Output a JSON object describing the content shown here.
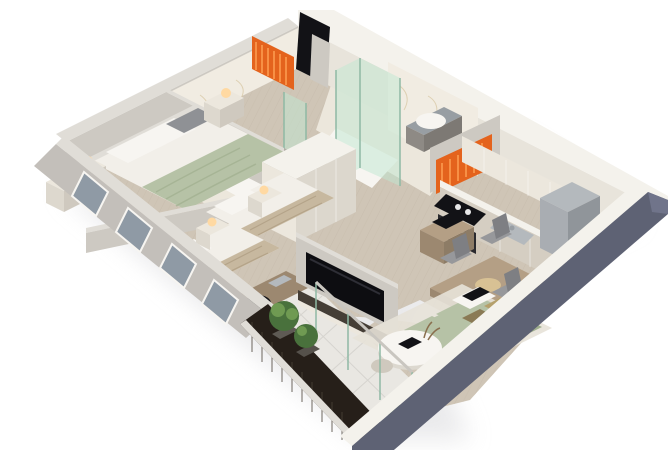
{
  "scene": {
    "title": "3D isometric apartment floor plan render",
    "description": "Cut-away 3D render of a two-bedroom apartment viewed from above: two bathrooms with glass showers and orange towel radiators, master bedroom with double bed, second bedroom with two single beds and desk, central wardrobe, wall TV, kitchen with cooktop and fridge, dining table with chairs, sage-green sofa with round coffee table, and a balcony with dark wood slats and plants.",
    "style": "isometric cutaway, white background, soft shadow"
  },
  "rooms": [
    {
      "name": "bathroom-1",
      "items": [
        "orange-towel-radiator",
        "toilet",
        "glass-shower",
        "marble-walls"
      ]
    },
    {
      "name": "entry-hall",
      "items": [
        "dark-entry-door",
        "herringbone-floor"
      ]
    },
    {
      "name": "bathroom-2",
      "items": [
        "glass-shower",
        "wall-hung-sink",
        "marble-walls",
        "orange-towel-radiator"
      ]
    },
    {
      "name": "master-bedroom",
      "items": [
        "double-bed-sage-throw",
        "two-nightstands-with-lamps",
        "dresser-with-lamp",
        "wardrobe",
        "windows"
      ]
    },
    {
      "name": "second-bedroom",
      "items": [
        "single-bed-a",
        "single-bed-b",
        "nightstands-with-lamps",
        "desk-with-chair",
        "windows"
      ]
    },
    {
      "name": "kitchen",
      "items": [
        "upper-cabinets",
        "cooktop",
        "oven",
        "sink",
        "fridge",
        "microwave-cabinet"
      ]
    },
    {
      "name": "dining-area",
      "items": [
        "wood-table",
        "four-gray-chairs",
        "round-tray"
      ]
    },
    {
      "name": "living-room",
      "items": [
        "sage-sofa",
        "round-coffee-table",
        "rug",
        "tv-partition",
        "media-console",
        "decor"
      ]
    },
    {
      "name": "balcony",
      "items": [
        "dark-slat-wall",
        "white-tile-floor",
        "potted-plants",
        "glass-sliding-door"
      ]
    }
  ],
  "palette": {
    "bg": "#ffffff",
    "shadow": "#d9d9dc",
    "wallDark": "#5e6274",
    "wallDarkLight": "#70748a",
    "wallCreamTop": "#f4f2ec",
    "wallCreamFace": "#e8e4db",
    "wallGrayTop": "#e0ddd7",
    "wallGrayFace": "#cdc9c2",
    "wallGrayShade": "#b2aea8",
    "marble": "#f1ece2",
    "marbleVein": "#d6c5a0",
    "floorWood": "#cfc5b6",
    "floorWoodLine": "#b9ad9b",
    "floorMarble": "#ece7dc",
    "tile": "#e9e7e2",
    "tileLine": "#d6d4cf",
    "radiator": "#e4631d",
    "radiatorHi": "#f79045",
    "glass": "#bfe7d1",
    "glassEdge": "#8fb9a4",
    "white": "#f7f5f1",
    "bedWhite": "#f2efe9",
    "sage": "#b6c2a6",
    "sageDark": "#9fae8e",
    "beige": "#c7b89f",
    "beigeDark": "#b09f84",
    "pillowGray": "#8f9195",
    "wood": "#b49f85",
    "woodDark": "#9c8870",
    "cream": "#ece7dd",
    "steel": "#b4b9bd",
    "steelDark": "#989ea3",
    "black": "#121216",
    "tvDark": "#0d0d11",
    "consoleDark": "#453e36",
    "darkSlat": "#261f19",
    "plant": "#49713c",
    "plantLight": "#6f9a52",
    "chairGray": "#97989b",
    "chairDark": "#7e7f83",
    "rug": "#e7e2d8",
    "glow": "#ffd9a2",
    "winGlass": "#8f9aa5"
  }
}
